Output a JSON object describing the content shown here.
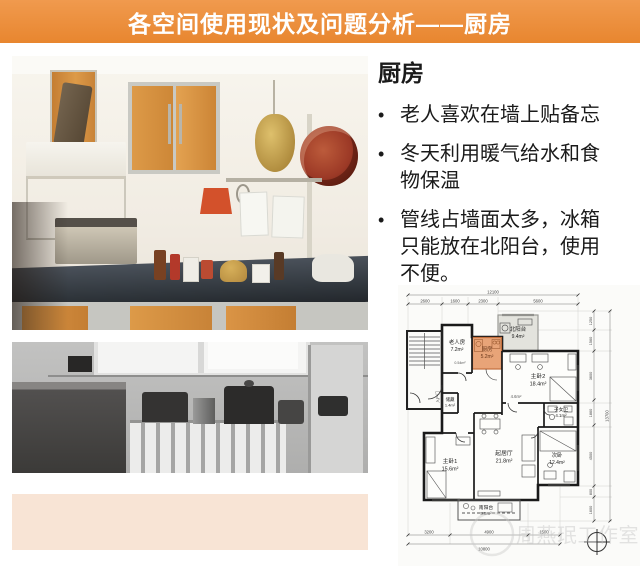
{
  "header": {
    "title": "各空间使用现状及问题分析——厨房"
  },
  "panel": {
    "title": "厨房",
    "bullet_glyph": "•",
    "bullets": [
      "老人喜欢在墙上贴备忘",
      "冬天利用暖气给水和食物保温",
      "管线占墙面太多，冰箱只能放在北阳台，使用不便。"
    ]
  },
  "colors": {
    "header_bg": "#E8862F",
    "kitchen_highlight": "#E8A478",
    "peach_block": "#F8E4D5",
    "cabinet_orange": "#DD9440"
  },
  "floorplan": {
    "rooms": {
      "elder": {
        "name": "老人房",
        "area": "7.2m²"
      },
      "flue": {
        "area": "0.54m²"
      },
      "kitchen": {
        "name": "厨房",
        "area": "5.2m²"
      },
      "north_balcony": {
        "name": "北阳台",
        "area": "9.4m²"
      },
      "master2": {
        "name": "主卧2",
        "area": "18.4m²"
      },
      "storage": {
        "name": "储藏",
        "area": "1.4m²"
      },
      "hall": {
        "area": "4.6m²"
      },
      "kids_bath": {
        "name": "子女卫",
        "area": "4.1m²"
      },
      "master1": {
        "name": "主卧1",
        "area": "15.6m²"
      },
      "living": {
        "name": "起居厅",
        "area": "21.8m²"
      },
      "second": {
        "name": "次卧",
        "area": "12.4m²"
      },
      "south_balcony": {
        "name": "南阳台",
        "area": "5.8m²"
      },
      "entry_door": {
        "name": "入户门"
      }
    },
    "dims": {
      "top_total": "12100",
      "top": [
        "2600",
        "1600",
        "2300",
        "5600"
      ],
      "right": [
        "1250",
        "1560",
        "3600",
        "1860",
        "4500",
        "800",
        "1600"
      ],
      "right_total": "13700",
      "bottom": [
        "3200",
        "4900",
        "1500"
      ],
      "bottom_total": "10800"
    },
    "watermark": "周燕珉工作室"
  }
}
